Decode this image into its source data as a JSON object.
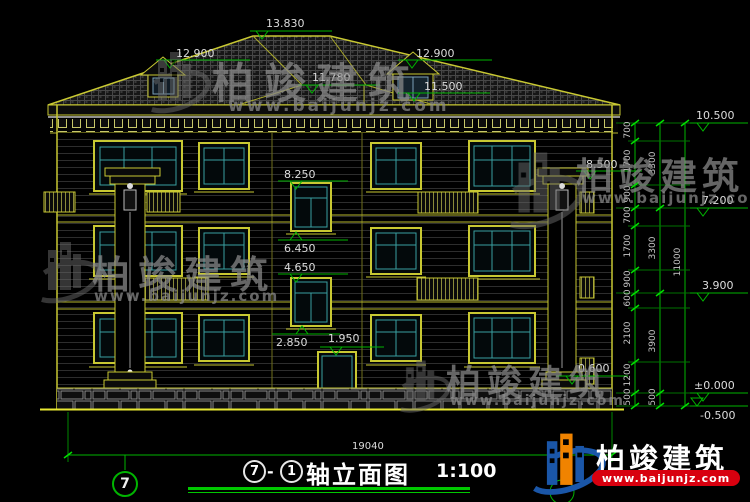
{
  "watermark": {
    "brand": "柏竣建筑",
    "url": "www.baijunjz.com"
  },
  "title": {
    "axis_start": "7",
    "separator": "-",
    "axis_end": "1",
    "name": "轴立面图",
    "scale": "1:100"
  },
  "axes": {
    "left_bubble": "7"
  },
  "dimensions": {
    "overall_width": "19040"
  },
  "marks": {
    "ridge": "13.830",
    "dormer_left": "12.900",
    "dormer_right": "12.900",
    "sub_ridge": "11.780",
    "dormer_right_base": "11.500",
    "pilaster_top": "8.500",
    "stair_win3_head": "8.250",
    "stair_win3_sill": "6.450",
    "stair_win2_head": "4.650",
    "porch": "2.850",
    "door_head": "1.950",
    "plinth_right": "0.600",
    "eave": "10.500",
    "floor3": "7.200",
    "floor2": "3.900",
    "floor1": "±0.000",
    "ground": "-0.500"
  },
  "chain": {
    "inner": [
      "700",
      "1700",
      "900",
      "700",
      "1700",
      "900",
      "600",
      "2100",
      "1200",
      "500"
    ],
    "mid": [
      "3300",
      "3300",
      "3900",
      "500"
    ],
    "total": "11000"
  },
  "colors": {
    "line_yellow": "#c8c832",
    "dim_green": "#00b400",
    "glass_teal": "#3aa0a0",
    "logo_blue": "#1a56a8",
    "logo_orange": "#f08300",
    "banner_red": "#d8000f"
  }
}
